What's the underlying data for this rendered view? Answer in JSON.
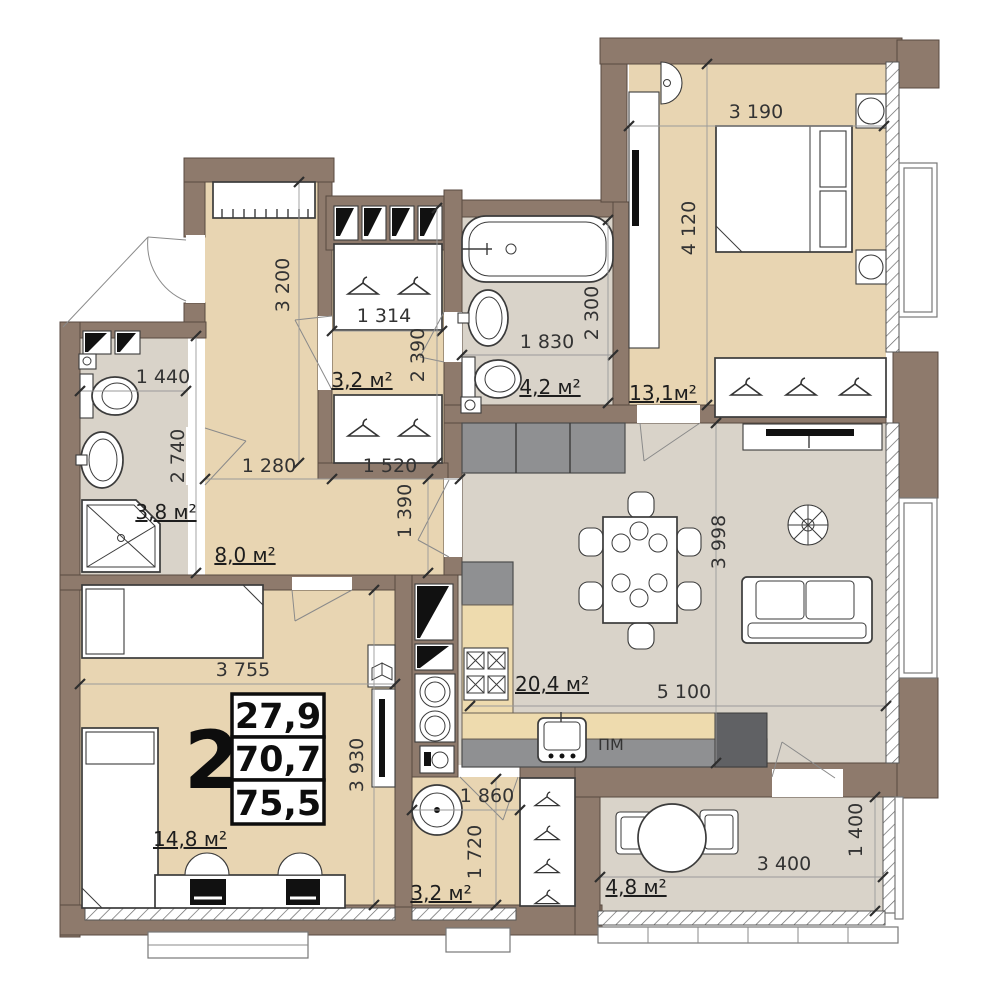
{
  "colors": {
    "wall": "#8e7a6c",
    "wall_outline": "#584a40",
    "wood_floor": "#e8d5b2",
    "tile_floor": "#d9d3c9",
    "counter": "#eedbae",
    "cabinet_grey": "#8f9092",
    "cabinet_dark": "#606164"
  },
  "stamp": {
    "rooms_count": "2",
    "areas": [
      "27,9",
      "70,7",
      "75,5"
    ]
  },
  "rooms": {
    "closet": {
      "area": "3,2 м²"
    },
    "bathroom": {
      "area": "4,2 м²"
    },
    "bedroom": {
      "area": "13,1м²"
    },
    "bathroom_small": {
      "area": "3,8 м²"
    },
    "hall": {
      "area": "8,0 м²"
    },
    "living_kitchen": {
      "area": "20,4 м²"
    },
    "children_room": {
      "area": "14,8 м²"
    },
    "laundry": {
      "area": "3,2 м²"
    },
    "balcony": {
      "area": "4,8 м²"
    }
  },
  "dimensions_mm": {
    "bedroom_width": "3 190",
    "bedroom_depth": "4 120",
    "corridor_depth": "3 200",
    "closet_width": "1 314",
    "closet_depth": "2 390",
    "closet_outer_width": "1 520",
    "hall_width": "1 280",
    "bathroom_width": "1 830",
    "bathroom_depth": "2 300",
    "bathroom_small_width": "1 440",
    "bathroom_small_depth": "2 740",
    "hall_passage_depth": "1 390",
    "living_width": "5 100",
    "living_depth": "3 998",
    "children_width": "3 755",
    "children_depth": "3 930",
    "laundry_width": "1 860",
    "laundry_depth": "1 720",
    "balcony_width": "3 400",
    "balcony_depth": "1 400"
  },
  "labels": {
    "dishwasher": "ПМ"
  }
}
